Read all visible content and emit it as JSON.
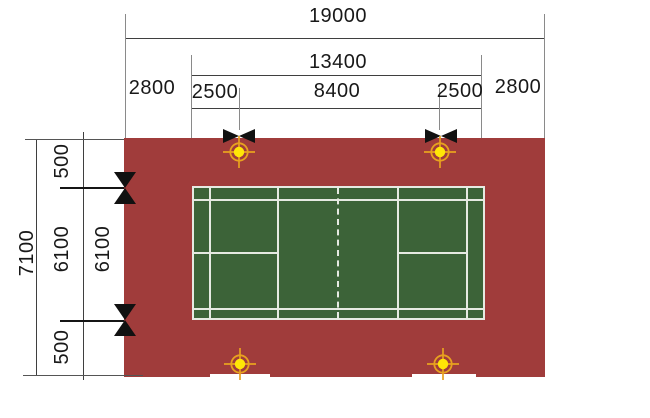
{
  "dim_top": {
    "total": "19000",
    "court_length": "13400",
    "margin_left": "2800",
    "post_offset_left": "2500",
    "post_span": "8400",
    "post_offset_right": "2500",
    "margin_right": "2800"
  },
  "dim_left": {
    "total": "7100",
    "margin_top": "500",
    "court_width_outer": "6100",
    "court_width_inner": "6100",
    "margin_bottom": "500"
  },
  "colors": {
    "apron_red": "#a03c3b",
    "court_green": "#3c6338",
    "court_line_white": "#e6eae2",
    "marker_yellow": "#ffe606",
    "marker_orange": "#e8a21f",
    "dim_line": "#3f3f3f",
    "text": "#181818"
  }
}
